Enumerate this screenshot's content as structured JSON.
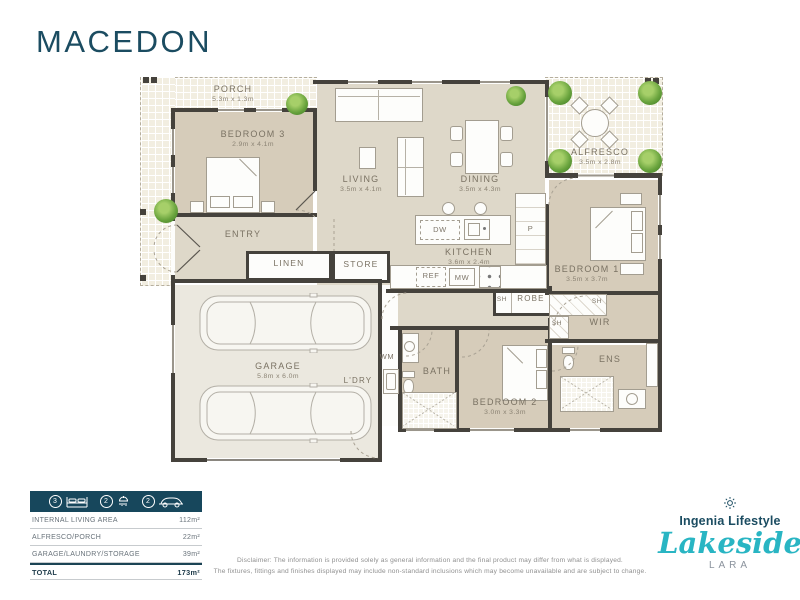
{
  "title": "MACEDON",
  "plan": {
    "rooms": {
      "porch": {
        "name": "PORCH",
        "dims": "5.3m x 1.3m"
      },
      "bedroom3": {
        "name": "BEDROOM 3",
        "dims": "2.9m x 4.1m"
      },
      "living": {
        "name": "LIVING",
        "dims": "3.5m x 4.1m"
      },
      "dining": {
        "name": "DINING",
        "dims": "3.5m x 4.3m"
      },
      "alfresco": {
        "name": "ALFRESCO",
        "dims": "3.5m x 2.8m"
      },
      "kitchen": {
        "name": "KITCHEN",
        "dims": "3.6m x 2.4m"
      },
      "bedroom1": {
        "name": "BEDROOM 1",
        "dims": "3.5m x 3.7m"
      },
      "bedroom2": {
        "name": "BEDROOM 2",
        "dims": "3.0m x 3.3m"
      },
      "garage": {
        "name": "GARAGE",
        "dims": "5.8m x 6.0m"
      },
      "entry": {
        "name": "ENTRY"
      },
      "linen": {
        "name": "LINEN"
      },
      "store": {
        "name": "STORE"
      },
      "wir": {
        "name": "WIR"
      },
      "robe": {
        "name": "ROBE"
      },
      "ens": {
        "name": "ENS"
      },
      "bath": {
        "name": "BATH"
      },
      "laundry": {
        "name": "L'DRY"
      }
    },
    "fixtures": {
      "dw": "DW",
      "wm": "WM",
      "ref": "REF",
      "mw": "MW",
      "pantry": "P",
      "shelf": "SH"
    }
  },
  "summary": {
    "features": [
      {
        "count": "3",
        "type": "bedrooms"
      },
      {
        "count": "2",
        "type": "bathrooms"
      },
      {
        "count": "2",
        "type": "cars"
      }
    ],
    "rows": [
      {
        "label": "INTERNAL LIVING AREA",
        "value": "112m²"
      },
      {
        "label": "ALFRESCO/PORCH",
        "value": "22m²"
      },
      {
        "label": "GARAGE/LAUNDRY/STORAGE",
        "value": "39m²"
      }
    ],
    "total": {
      "label": "TOTAL",
      "value": "173m²"
    }
  },
  "disclaimer": {
    "line1": "Disclaimer: The information is provided solely as general information and the final product may differ from what is displayed.",
    "line2": "The fixtures, fittings and finishes displayed may include non-standard inclusions which may become unavailable and are subject to change."
  },
  "logo": {
    "brand": "Ingenia Lifestyle",
    "community": "Lakeside",
    "location": "LARA"
  },
  "colors": {
    "accent": "#1b4c61",
    "teal": "#29b5c3",
    "wall": "#45423c"
  }
}
